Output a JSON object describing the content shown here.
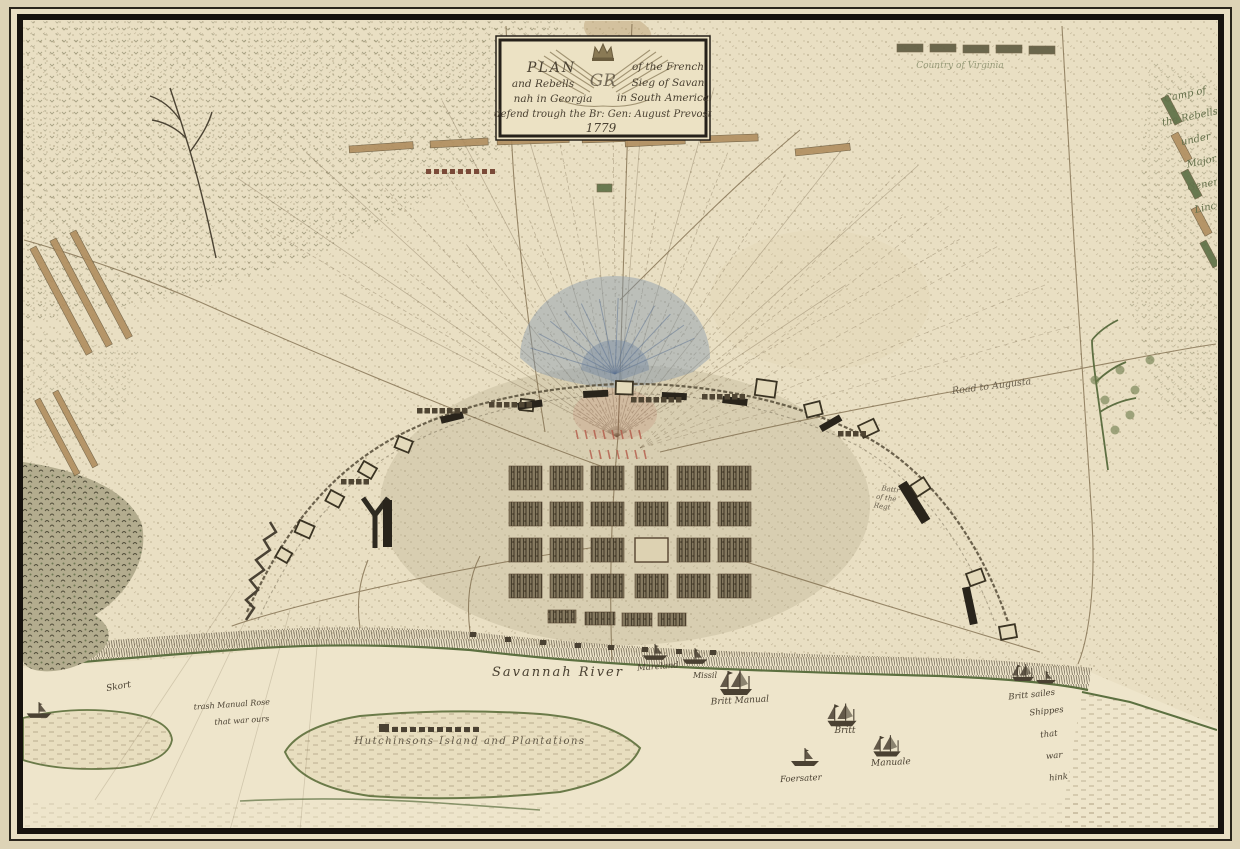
{
  "meta": {
    "title": "Plan of the French and Rebells Siege of Savannah 1779"
  },
  "cartouche": {
    "plan": "PLAN",
    "of_the_french": "of the French",
    "and_rebells": "and Rebells",
    "sieg_of_savan": "Sieg of Savan",
    "nah_in_georgia": "nah in Georgia",
    "in_south_america": "in South America",
    "defend_line": "defend trough the Br: Gen: August Prevost",
    "year": "1779",
    "cipher": "GR"
  },
  "labels": {
    "virginia_camp": "Country of Virginia",
    "rebel_camp_lines": [
      "Camp of",
      "the Rebells",
      "under",
      "Major",
      "General",
      "Lincoln"
    ],
    "road_augusta": "Road to Augusta",
    "river": "Savannah River",
    "galley_1": "Mareland",
    "galley_2": "Missil",
    "ship_1": "Britt Manual",
    "ship_2": "Britt",
    "ship_3": "Manuale",
    "ship_4": "Foersater",
    "sunk_ships_lines": [
      "Britt sailes",
      "Shippes",
      "that",
      "war",
      "hink"
    ],
    "island": "Hutchinsons Island and Plantations",
    "shoal": "Skort",
    "sunk_note_lines": [
      "trash Manual Rose",
      "that war ours"
    ],
    "battery_lines": [
      "Battr",
      "of the",
      "Regt"
    ]
  },
  "colors": {
    "paper": "#e9dfc3",
    "ink": "#4a4132",
    "border": "#17130e",
    "bank_green": "#5c7040",
    "camp_green": "#5c6e44",
    "tan": "#b08e5f",
    "blue_fan": "#7e93ab",
    "red": "#b05242",
    "olive": "#5e5b40"
  }
}
